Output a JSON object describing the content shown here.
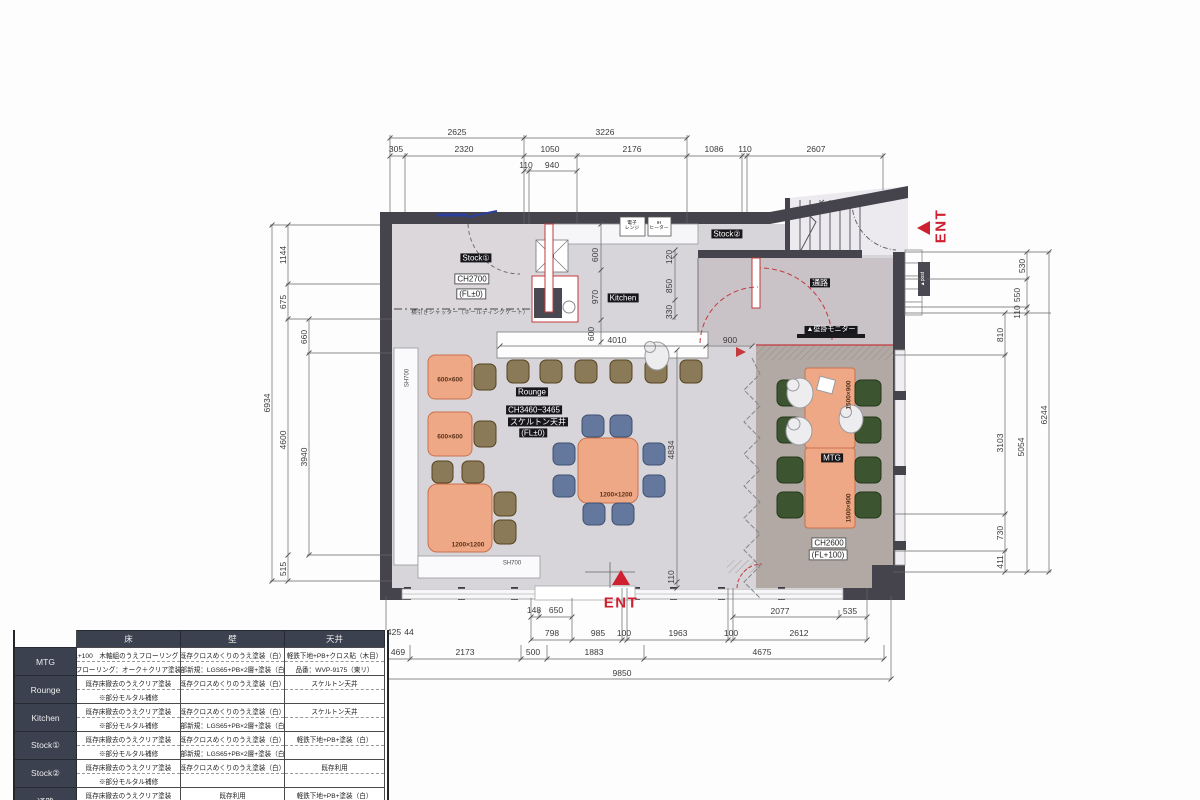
{
  "finish_table": {
    "title": "【仕上表】",
    "columns": [
      "床",
      "壁",
      "天井"
    ],
    "rows": [
      {
        "label": "MTG",
        "floor": [
          "FL+100　木軸組のうえフローリング 貼",
          "フローリング：オーク＋クリア塗装"
        ],
        "wall": [
          "既存クロスめくりのうえ塗装（白）",
          "一部新規：LGS65+PB×2層+塗装（白）"
        ],
        "ceiling": [
          "軽鉄下地+PB+クロス貼（木目）",
          "品番：WVP-9175（東リ）"
        ]
      },
      {
        "label": "Rounge",
        "floor": [
          "既存床撤去のうえクリア塗装",
          "※部分モルタル補修"
        ],
        "wall": [
          "既存クロスめくりのうえ塗装（白）",
          ""
        ],
        "ceiling": [
          "スケルトン天井",
          ""
        ]
      },
      {
        "label": "Kitchen",
        "floor": [
          "既存床撤去のうえクリア塗装",
          "※部分モルタル補修"
        ],
        "wall": [
          "既存クロスめくりのうえ塗装（白）",
          "一部新規：LGS65+PB×2層+塗装（白）"
        ],
        "ceiling": [
          "スケルトン天井",
          ""
        ]
      },
      {
        "label": "Stock①",
        "floor": [
          "既存床撤去のうえクリア塗装",
          "※部分モルタル補修"
        ],
        "wall": [
          "既存クロスめくりのうえ塗装（白）",
          "一部新規：LGS65+PB×2層+塗装（白）"
        ],
        "ceiling": [
          "軽鉄下地+PB+塗装（白）",
          ""
        ]
      },
      {
        "label": "Stock②",
        "floor": [
          "既存床撤去のうえクリア塗装",
          "※部分モルタル補修"
        ],
        "wall": [
          "既存クロスめくりのうえ塗装（白）",
          ""
        ],
        "ceiling": [
          "既存利用",
          ""
        ]
      },
      {
        "label": "通路",
        "floor": [
          "既存床撤去のうえクリア塗装",
          "※部分モルタル補修"
        ],
        "wall": [
          "既存利用",
          "一部新規：LGS65+PB×2層+塗装（白）"
        ],
        "ceiling": [
          "軽鉄下地+PB+塗装（白）",
          ""
        ]
      }
    ]
  },
  "plan": {
    "labels": [
      {
        "t": "Stock①",
        "x": 476,
        "y": 258,
        "cls": "dark",
        "name": "room-label-stock1"
      },
      {
        "t": "CH2700",
        "x": 472,
        "y": 279,
        "cls": "box",
        "name": "ceiling-height-stock1"
      },
      {
        "t": "(FL±0)",
        "x": 471,
        "y": 294,
        "cls": "box",
        "name": "floor-level-stock1"
      },
      {
        "t": "Kitchen",
        "x": 623,
        "y": 298,
        "cls": "dark",
        "name": "room-label-kitchen"
      },
      {
        "t": "Stock②",
        "x": 727,
        "y": 234,
        "cls": "dark",
        "name": "room-label-stock2"
      },
      {
        "t": "通路",
        "x": 820,
        "y": 283,
        "cls": "dark",
        "name": "room-label-corridor"
      },
      {
        "t": "Rounge",
        "x": 532,
        "y": 392,
        "cls": "dark",
        "name": "room-label-rounge"
      },
      {
        "t": "CH3460~3465",
        "x": 534,
        "y": 410,
        "cls": "dark",
        "name": "ceiling-height-rounge"
      },
      {
        "t": "スケルトン天井",
        "x": 538,
        "y": 422,
        "cls": "dark",
        "name": "ceiling-type-rounge"
      },
      {
        "t": "(FL±0)",
        "x": 533,
        "y": 433,
        "cls": "dark",
        "name": "floor-level-rounge"
      },
      {
        "t": "MTG",
        "x": 832,
        "y": 458,
        "cls": "dark",
        "name": "room-label-mtg"
      },
      {
        "t": "CH2600",
        "x": 829,
        "y": 543,
        "cls": "box",
        "name": "ceiling-height-mtg"
      },
      {
        "t": "(FL+100)",
        "x": 828,
        "y": 555,
        "cls": "box",
        "name": "floor-level-mtg"
      },
      {
        "t": "▲壁掛モニター",
        "x": 831,
        "y": 330,
        "cls": "dark",
        "fs": 7,
        "name": "wall-monitor-label"
      },
      {
        "t": "▲post",
        "x": 924,
        "y": 279,
        "cls": "postlbl",
        "r": -90,
        "name": "post-label"
      },
      {
        "t": "ENT",
        "x": 941,
        "y": 226,
        "cls": "ent",
        "r": -90,
        "name": "entrance-label-right"
      },
      {
        "t": "ENT",
        "x": 621,
        "y": 603,
        "cls": "ent",
        "name": "entrance-label-bottom"
      },
      {
        "t": "600×600",
        "x": 450,
        "y": 380,
        "cls": "tbl",
        "name": "table-size-label"
      },
      {
        "t": "600×600",
        "x": 450,
        "y": 437,
        "cls": "tbl",
        "name": "table-size-label"
      },
      {
        "t": "1200×1200",
        "x": 468,
        "y": 545,
        "cls": "tbl",
        "name": "table-size-label"
      },
      {
        "t": "1200×1200",
        "x": 616,
        "y": 495,
        "cls": "tbl",
        "name": "table-size-label"
      },
      {
        "t": "1500×900",
        "x": 849,
        "y": 395,
        "cls": "tbl",
        "r": -90,
        "name": "table-size-label"
      },
      {
        "t": "1500×900",
        "x": 849,
        "y": 508,
        "cls": "tbl",
        "r": -90,
        "name": "table-size-label"
      },
      {
        "t": "SH700",
        "x": 408,
        "y": 378,
        "cls": "sh",
        "r": -90,
        "name": "bench-height-label"
      },
      {
        "t": "SH700",
        "x": 512,
        "y": 564,
        "cls": "sh",
        "name": "bench-height-label"
      },
      {
        "t": "横引きシャッター（ホールディングゲート）",
        "x": 470,
        "y": 313,
        "cls": "tiny",
        "name": "shutter-note"
      },
      {
        "t": "電子\nレンジ",
        "x": 632,
        "y": 226,
        "cls": "appl",
        "name": "microwave-label"
      },
      {
        "t": "IH\nヒーター",
        "x": 659,
        "y": 226,
        "cls": "appl",
        "name": "ih-heater-label"
      }
    ],
    "dimensions": [
      {
        "t": "2625",
        "x": 457,
        "y": 133
      },
      {
        "t": "3226",
        "x": 605,
        "y": 133
      },
      {
        "t": "305",
        "x": 396,
        "y": 150
      },
      {
        "t": "2320",
        "x": 464,
        "y": 150
      },
      {
        "t": "1050",
        "x": 550,
        "y": 150
      },
      {
        "t": "2176",
        "x": 632,
        "y": 150
      },
      {
        "t": "1086",
        "x": 714,
        "y": 150
      },
      {
        "t": "110",
        "x": 745,
        "y": 150
      },
      {
        "t": "2607",
        "x": 816,
        "y": 150
      },
      {
        "t": "110",
        "x": 526,
        "y": 166
      },
      {
        "t": "940",
        "x": 552,
        "y": 166
      },
      {
        "t": "6934",
        "x": 268,
        "y": 403,
        "r": -90
      },
      {
        "t": "1144",
        "x": 284,
        "y": 255,
        "r": -90
      },
      {
        "t": "675",
        "x": 284,
        "y": 302,
        "r": -90
      },
      {
        "t": "660",
        "x": 305,
        "y": 337,
        "r": -90
      },
      {
        "t": "4600",
        "x": 284,
        "y": 440,
        "r": -90
      },
      {
        "t": "3940",
        "x": 305,
        "y": 457,
        "r": -90
      },
      {
        "t": "515",
        "x": 284,
        "y": 569,
        "r": -90
      },
      {
        "t": "530",
        "x": 1023,
        "y": 266,
        "r": -90
      },
      {
        "t": "550",
        "x": 1018,
        "y": 295,
        "r": -90
      },
      {
        "t": "110",
        "x": 1018,
        "y": 312,
        "r": -90
      },
      {
        "t": "810",
        "x": 1001,
        "y": 335,
        "r": -90
      },
      {
        "t": "3103",
        "x": 1001,
        "y": 443,
        "r": -90
      },
      {
        "t": "5054",
        "x": 1022,
        "y": 447,
        "r": -90
      },
      {
        "t": "6244",
        "x": 1045,
        "y": 415,
        "r": -90
      },
      {
        "t": "730",
        "x": 1001,
        "y": 533,
        "r": -90
      },
      {
        "t": "411",
        "x": 1001,
        "y": 562,
        "r": -90
      },
      {
        "t": "600",
        "x": 596,
        "y": 255,
        "r": -90
      },
      {
        "t": "970",
        "x": 596,
        "y": 297,
        "r": -90
      },
      {
        "t": "600",
        "x": 592,
        "y": 334,
        "r": -90
      },
      {
        "t": "120",
        "x": 670,
        "y": 257,
        "r": -90
      },
      {
        "t": "850",
        "x": 670,
        "y": 286,
        "r": -90
      },
      {
        "t": "330",
        "x": 670,
        "y": 312,
        "r": -90
      },
      {
        "t": "4010",
        "x": 617,
        "y": 341
      },
      {
        "t": "900",
        "x": 730,
        "y": 341
      },
      {
        "t": "4834",
        "x": 672,
        "y": 450,
        "r": -90
      },
      {
        "t": "110",
        "x": 672,
        "y": 577,
        "r": -90
      },
      {
        "t": "148",
        "x": 534,
        "y": 611
      },
      {
        "t": "650",
        "x": 556,
        "y": 611
      },
      {
        "t": "2077",
        "x": 780,
        "y": 612
      },
      {
        "t": "535",
        "x": 850,
        "y": 612
      },
      {
        "t": "425",
        "x": 394,
        "y": 633
      },
      {
        "t": "44",
        "x": 409,
        "y": 633
      },
      {
        "t": "798",
        "x": 552,
        "y": 634
      },
      {
        "t": "985",
        "x": 598,
        "y": 634
      },
      {
        "t": "100",
        "x": 624,
        "y": 634
      },
      {
        "t": "1963",
        "x": 678,
        "y": 634
      },
      {
        "t": "100",
        "x": 731,
        "y": 634
      },
      {
        "t": "2612",
        "x": 799,
        "y": 634
      },
      {
        "t": "469",
        "x": 398,
        "y": 653
      },
      {
        "t": "2173",
        "x": 465,
        "y": 653
      },
      {
        "t": "500",
        "x": 533,
        "y": 653
      },
      {
        "t": "1883",
        "x": 594,
        "y": 653
      },
      {
        "t": "4675",
        "x": 762,
        "y": 653
      },
      {
        "t": "9850",
        "x": 622,
        "y": 674
      }
    ]
  },
  "colors": {
    "accent_red": "#c4373c",
    "wall": "#45434b",
    "table_salmon": "#efa886",
    "chair_blue": "#64789d",
    "chair_green": "#3c5530",
    "chair_brown": "#8a7a58"
  }
}
